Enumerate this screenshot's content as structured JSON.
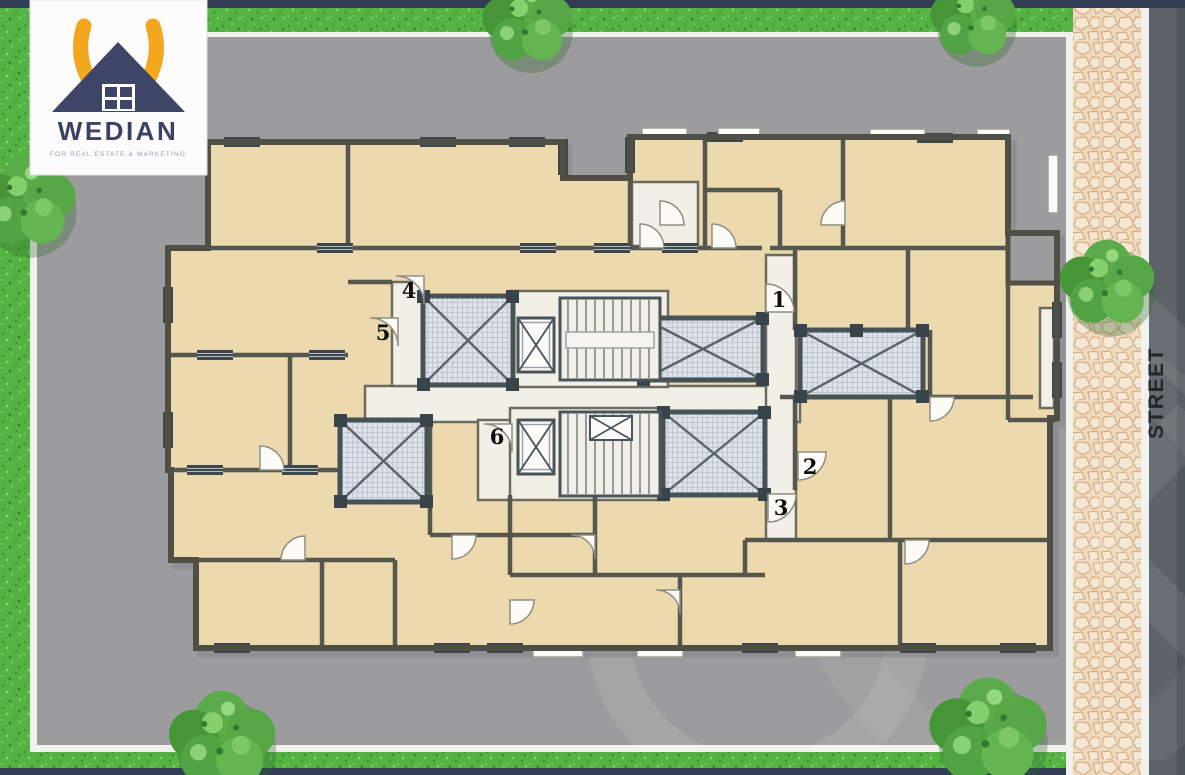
{
  "brand": {
    "name": "WEDIAN",
    "tagline": "FOR REAL ESTATE & MARKETING"
  },
  "street": {
    "label": "STREET"
  },
  "units": [
    {
      "label": "1"
    },
    {
      "label": "2"
    },
    {
      "label": "3"
    },
    {
      "label": "4"
    },
    {
      "label": "5"
    },
    {
      "label": "6"
    }
  ],
  "palette": {
    "border_navy": "#313d55",
    "grass_green": "#55b343",
    "plot_gray": "#9c9c9e",
    "room_beige": "#ecd9ae",
    "wall_dark": "#55564d",
    "interior_white": "#f2efe7",
    "lightwell_gray": "#dde1e8",
    "cobblestone": "#f0dcc0",
    "street_gray": "#5c6268",
    "logo_yellow": "#f3a71e",
    "logo_navy": "#3e4566"
  }
}
